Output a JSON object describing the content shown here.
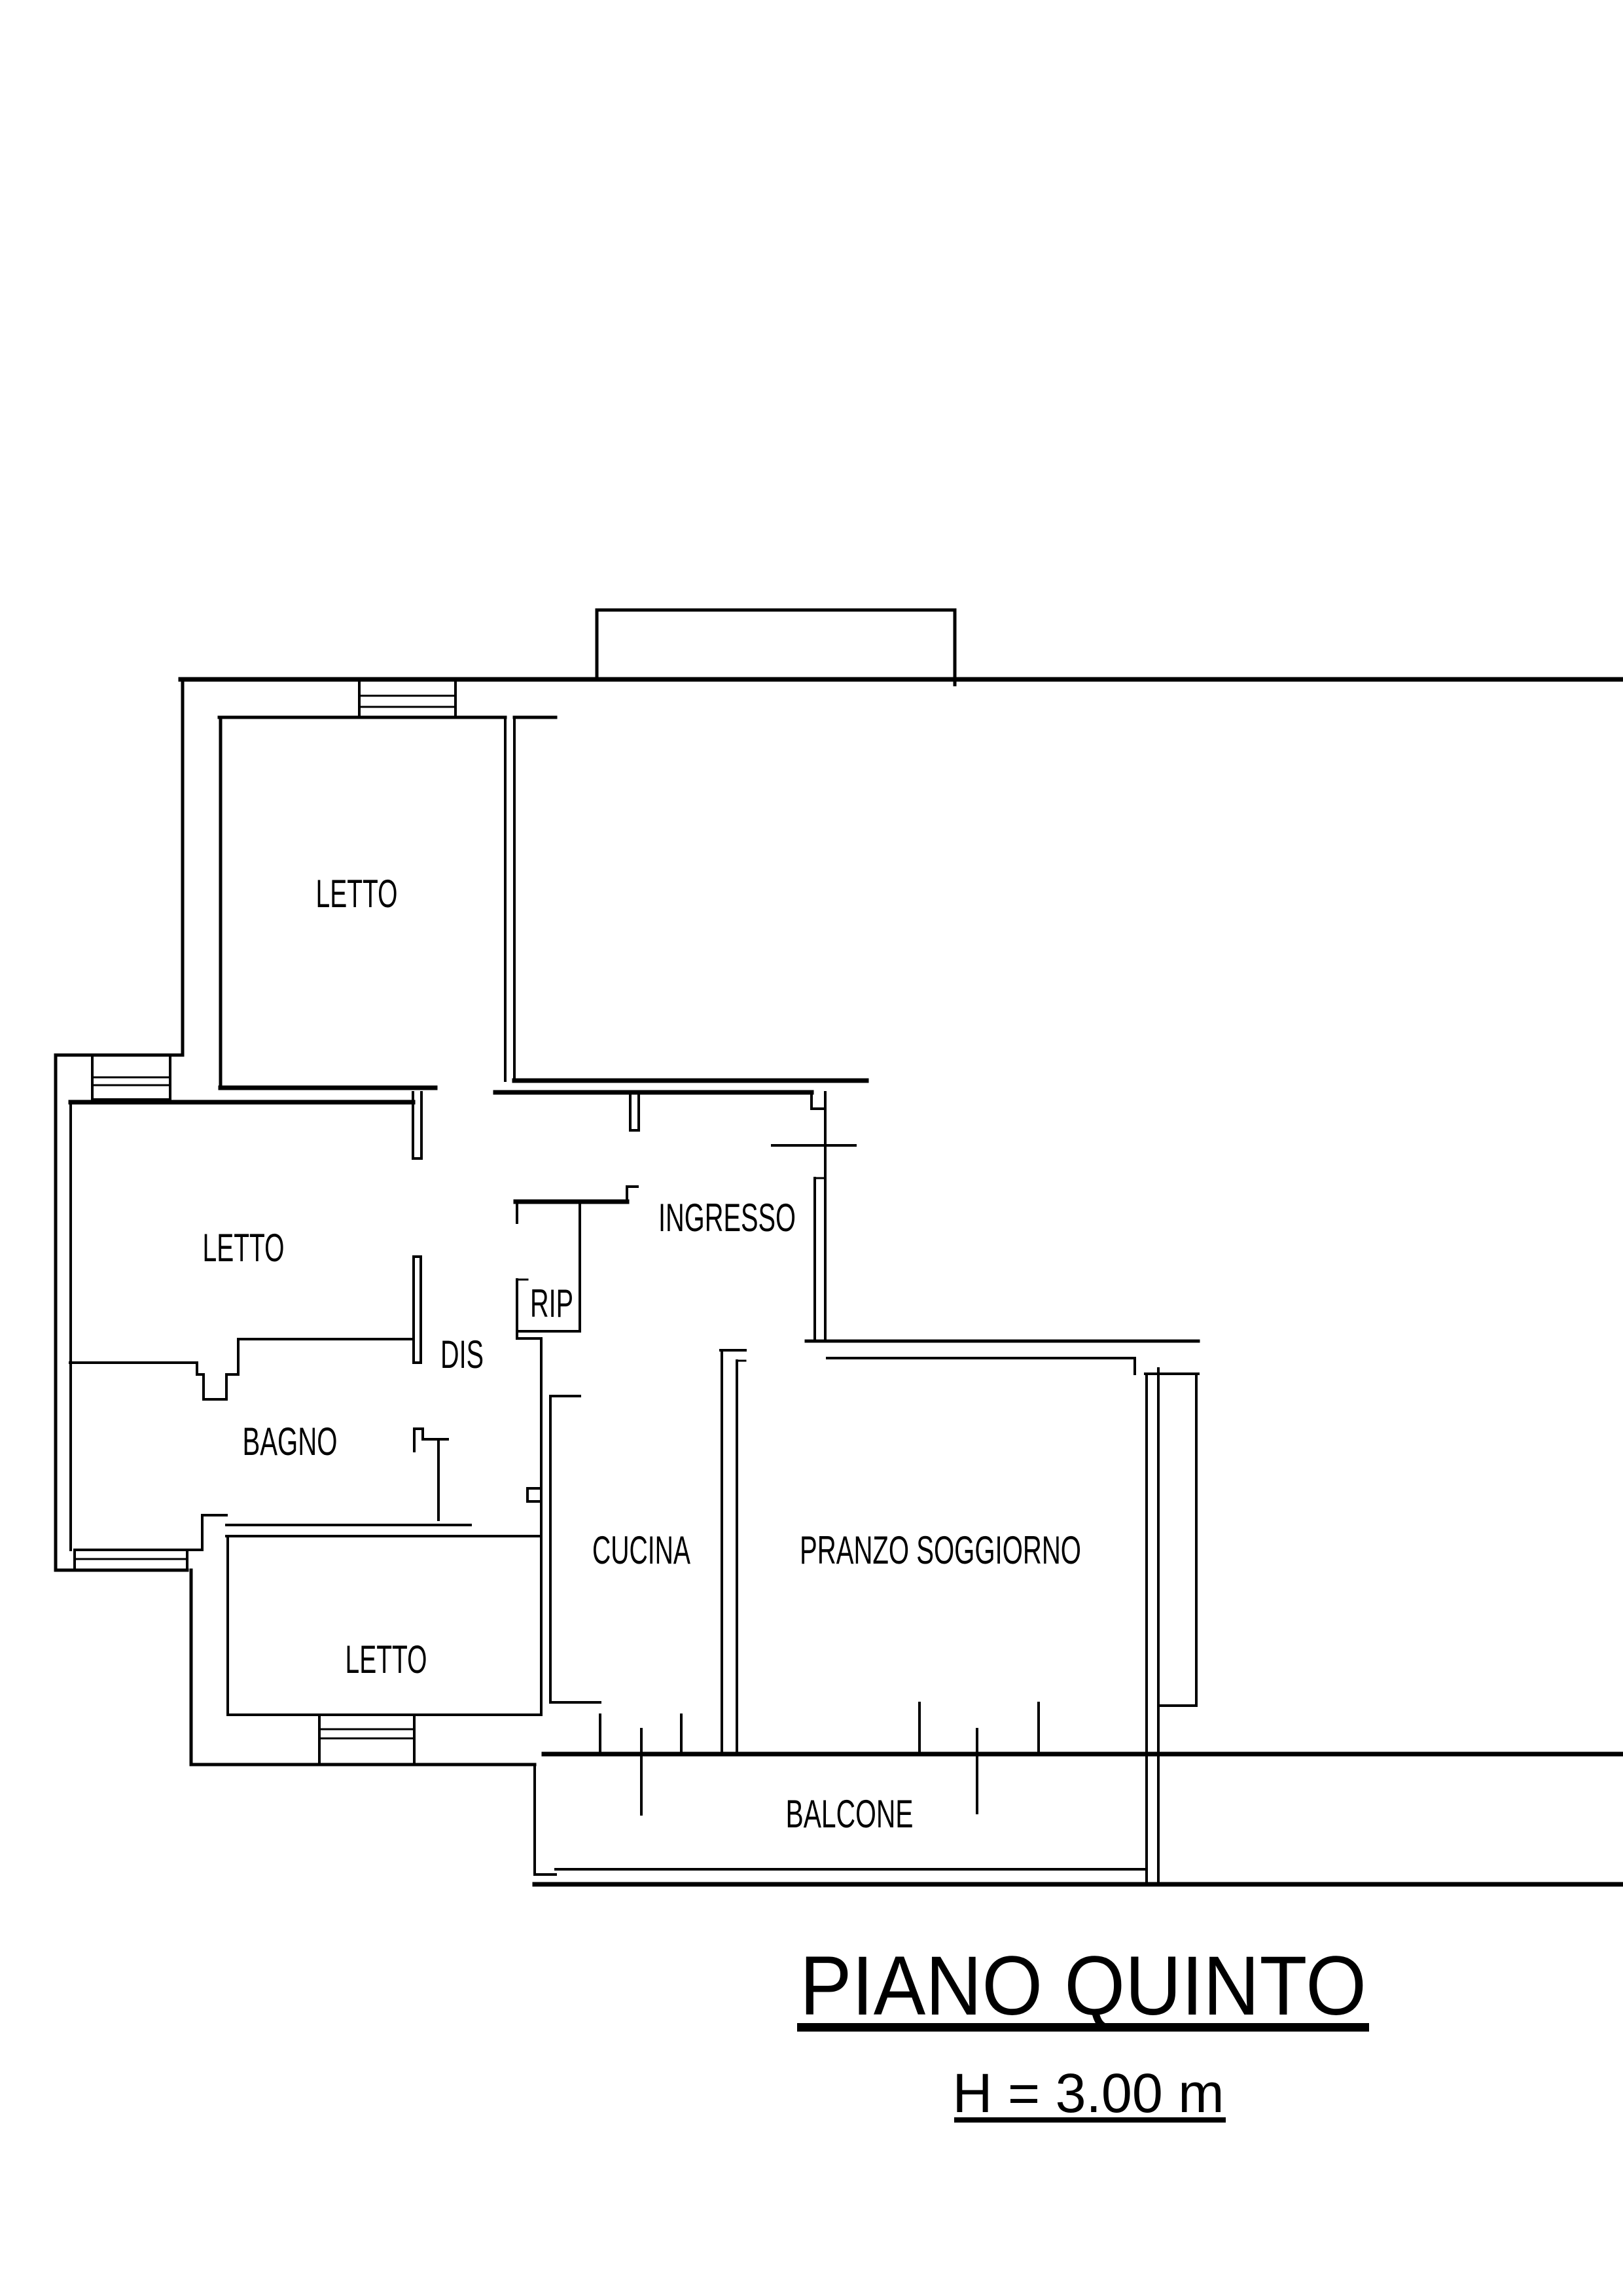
{
  "page": {
    "background_color": "#ffffff",
    "line_color": "#000000"
  },
  "floorplan": {
    "rooms": [
      {
        "id": "letto-top",
        "label": "LETTO"
      },
      {
        "id": "letto-mid",
        "label": "LETTO"
      },
      {
        "id": "dis",
        "label": "DIS"
      },
      {
        "id": "rip",
        "label": "RIP"
      },
      {
        "id": "ingresso",
        "label": "INGRESSO"
      },
      {
        "id": "bagno",
        "label": "BAGNO"
      },
      {
        "id": "cucina",
        "label": "CUCINA"
      },
      {
        "id": "pranzo-soggiorno",
        "label": "PRANZO SOGGIORNO"
      },
      {
        "id": "letto-bottom",
        "label": "LETTO"
      },
      {
        "id": "balcone",
        "label": "BALCONE"
      }
    ],
    "title_block": {
      "title": "PIANO QUINTO",
      "subtitle": "H = 3.00 m"
    }
  }
}
